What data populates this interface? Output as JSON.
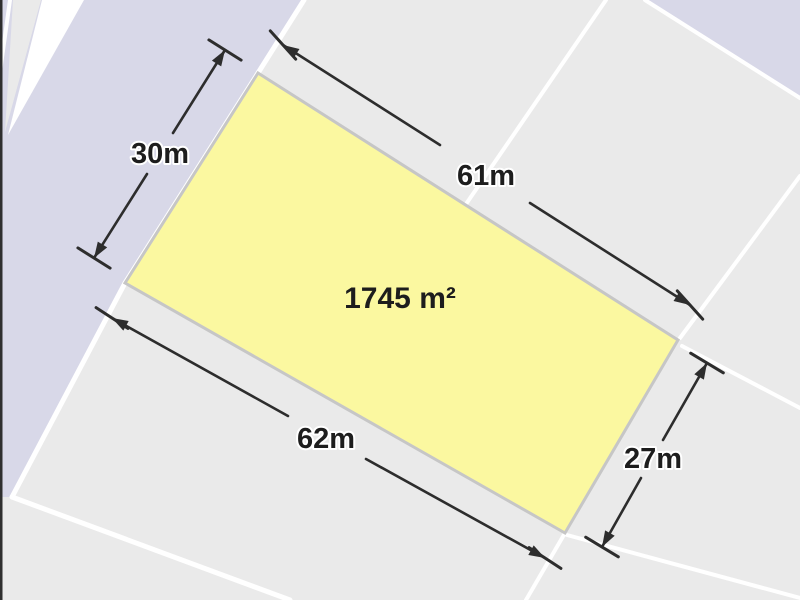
{
  "parcel": {
    "area_label": "1745 m²",
    "dim_top": "61m",
    "dim_left": "30m",
    "dim_bottom": "62m",
    "dim_right": "27m"
  },
  "colors": {
    "block_fill": "#eaeaea",
    "road_fill": "#d8d8e8",
    "parcel_fill": "#fbf8a0",
    "parcel_stroke": "#c6c6c6",
    "boundary_line": "#ffffff",
    "dimension_line": "#2d2d2d",
    "label_text": "#1d1d1d",
    "edge_border": "#2f2f2f"
  }
}
